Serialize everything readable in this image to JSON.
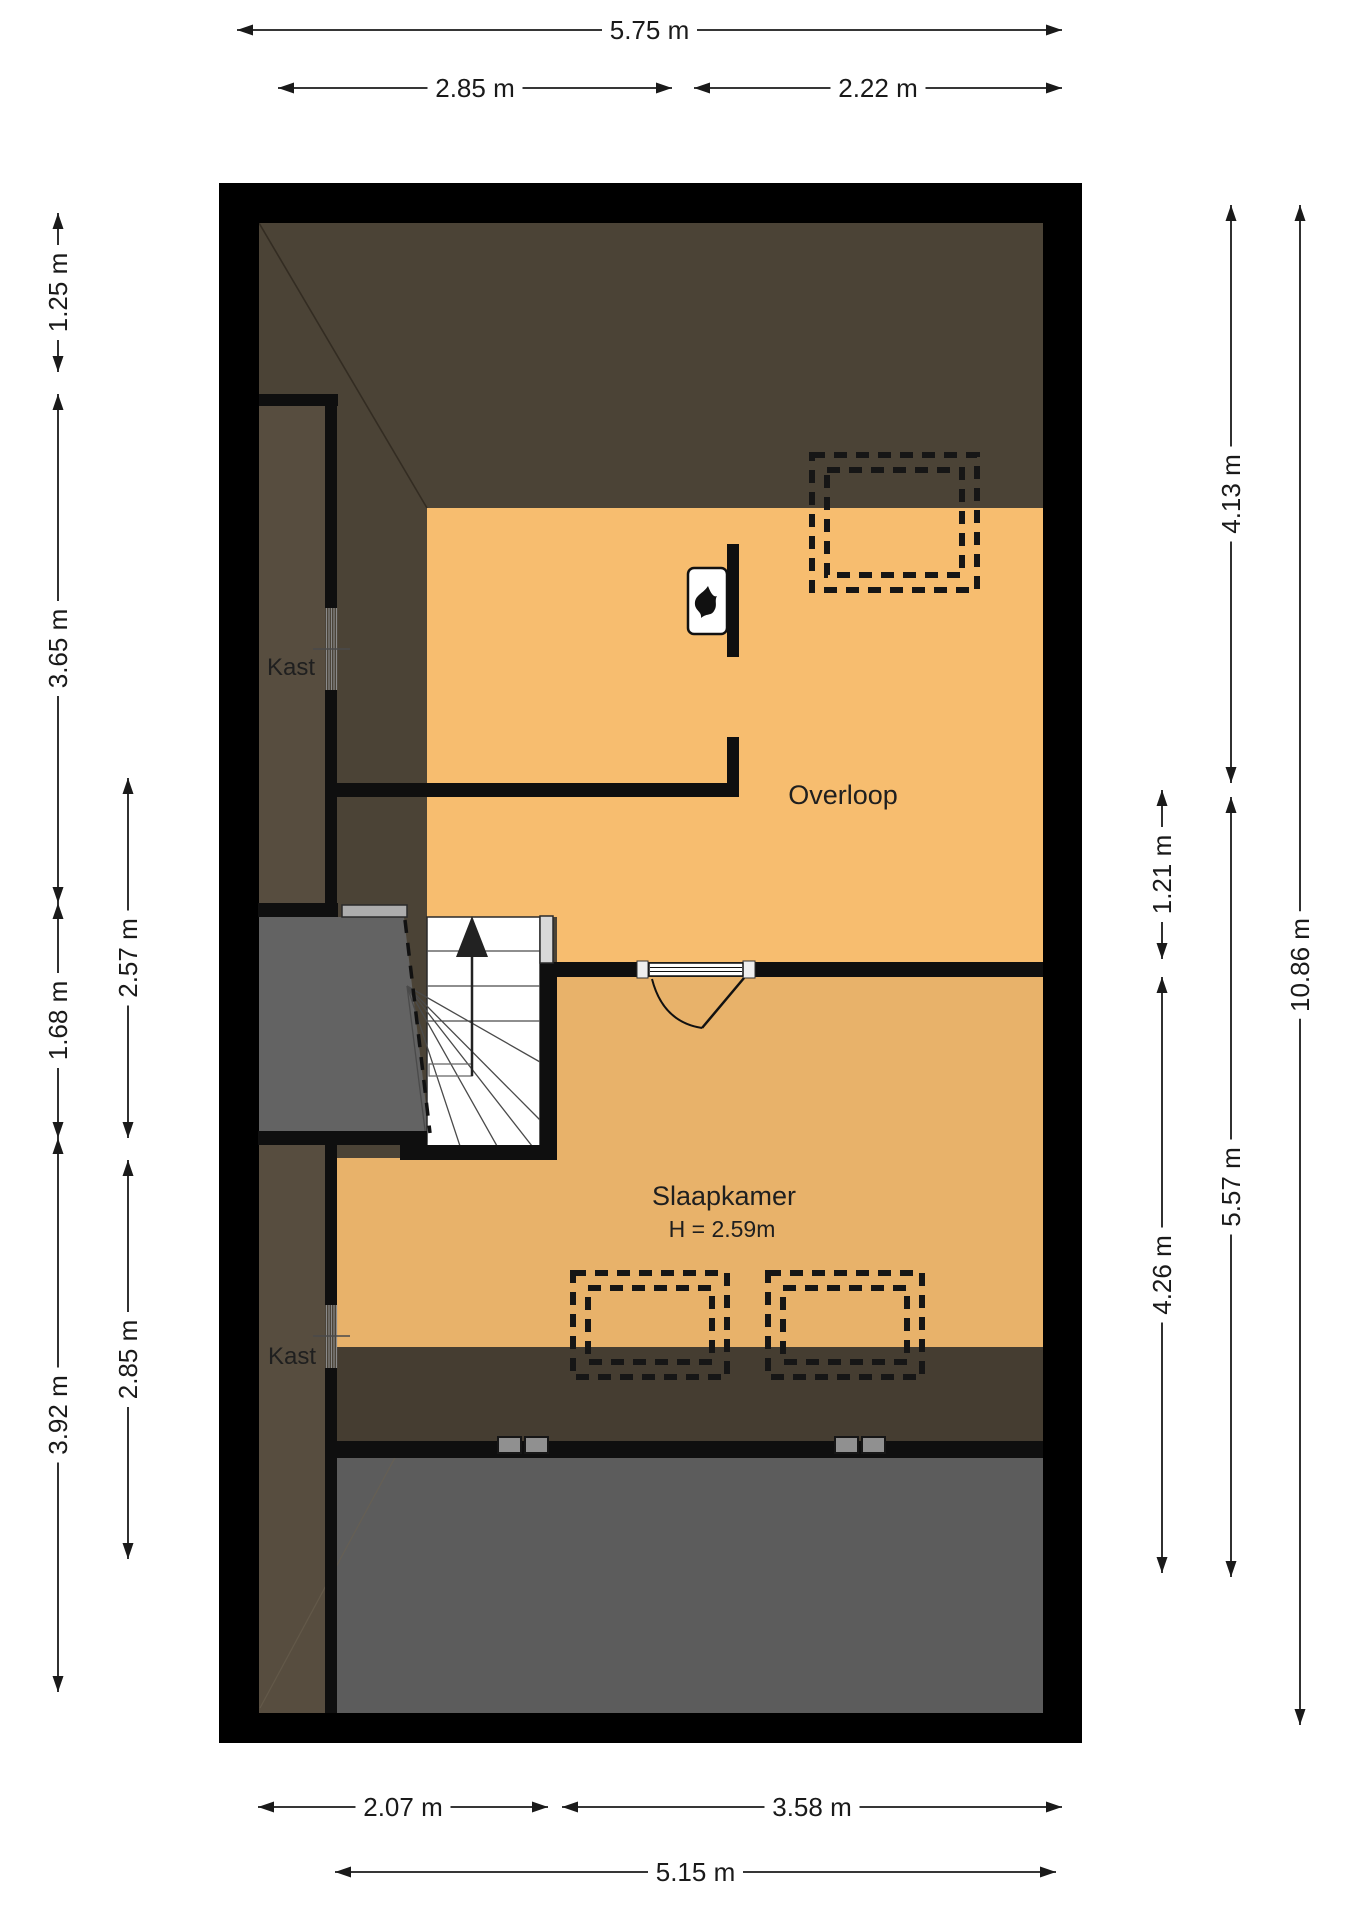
{
  "plan": {
    "type": "floor-plan",
    "rooms": {
      "overloop": {
        "label": "Overloop"
      },
      "slaapkamer": {
        "label": "Slaapkamer",
        "ceiling_height": "H = 2.59m"
      },
      "kast_upper": {
        "label": "Kast"
      },
      "kast_lower": {
        "label": "Kast"
      }
    },
    "dimensions": [
      {
        "side": "top",
        "label": "5.75 m",
        "orient": "h",
        "pos": 30,
        "from": 237,
        "to": 1062
      },
      {
        "side": "top",
        "label": "2.85 m",
        "orient": "h",
        "pos": 88,
        "from": 278,
        "to": 672
      },
      {
        "side": "top",
        "label": "2.22 m",
        "orient": "h",
        "pos": 88,
        "from": 694,
        "to": 1062
      },
      {
        "side": "left",
        "label": "1.25 m",
        "orient": "v",
        "pos": 58,
        "from": 213,
        "to": 372
      },
      {
        "side": "left",
        "label": "3.65 m",
        "orient": "v",
        "pos": 58,
        "from": 394,
        "to": 903
      },
      {
        "side": "left",
        "label": "1.68 m",
        "orient": "v",
        "pos": 58,
        "from": 903,
        "to": 1138
      },
      {
        "side": "left",
        "label": "3.92 m",
        "orient": "v",
        "pos": 58,
        "from": 1138,
        "to": 1692
      },
      {
        "side": "left",
        "label": "2.57 m",
        "orient": "v",
        "pos": 128,
        "from": 778,
        "to": 1138
      },
      {
        "side": "left",
        "label": "2.85 m",
        "orient": "v",
        "pos": 128,
        "from": 1160,
        "to": 1559
      },
      {
        "side": "right",
        "label": "1.21 m",
        "orient": "v",
        "pos": 1162,
        "from": 790,
        "to": 959
      },
      {
        "side": "right",
        "label": "4.26 m",
        "orient": "v",
        "pos": 1162,
        "from": 977,
        "to": 1573
      },
      {
        "side": "right",
        "label": "4.13 m",
        "orient": "v",
        "pos": 1231,
        "from": 205,
        "to": 783
      },
      {
        "side": "right",
        "label": "5.57 m",
        "orient": "v",
        "pos": 1231,
        "from": 797,
        "to": 1577
      },
      {
        "side": "right",
        "label": "10.86 m",
        "orient": "v",
        "pos": 1300,
        "from": 205,
        "to": 1725
      },
      {
        "side": "bottom",
        "label": "2.07 m",
        "orient": "h",
        "pos": 1807,
        "from": 258,
        "to": 548
      },
      {
        "side": "bottom",
        "label": "3.58 m",
        "orient": "h",
        "pos": 1807,
        "from": 562,
        "to": 1062
      },
      {
        "side": "bottom",
        "label": "5.15 m",
        "orient": "h",
        "pos": 1872,
        "from": 335,
        "to": 1056
      }
    ],
    "colors": {
      "wall": "#000000",
      "attic_slope": "#4b4336",
      "attic_slope_dark": "#453d31",
      "closet_floor": "#574d3f",
      "overloop_floor": "#f7bd6f",
      "slaapkamer_floor": "#e8b26a",
      "void_grey": "#5c5c5c",
      "stair_void_grey": "#636363"
    }
  }
}
